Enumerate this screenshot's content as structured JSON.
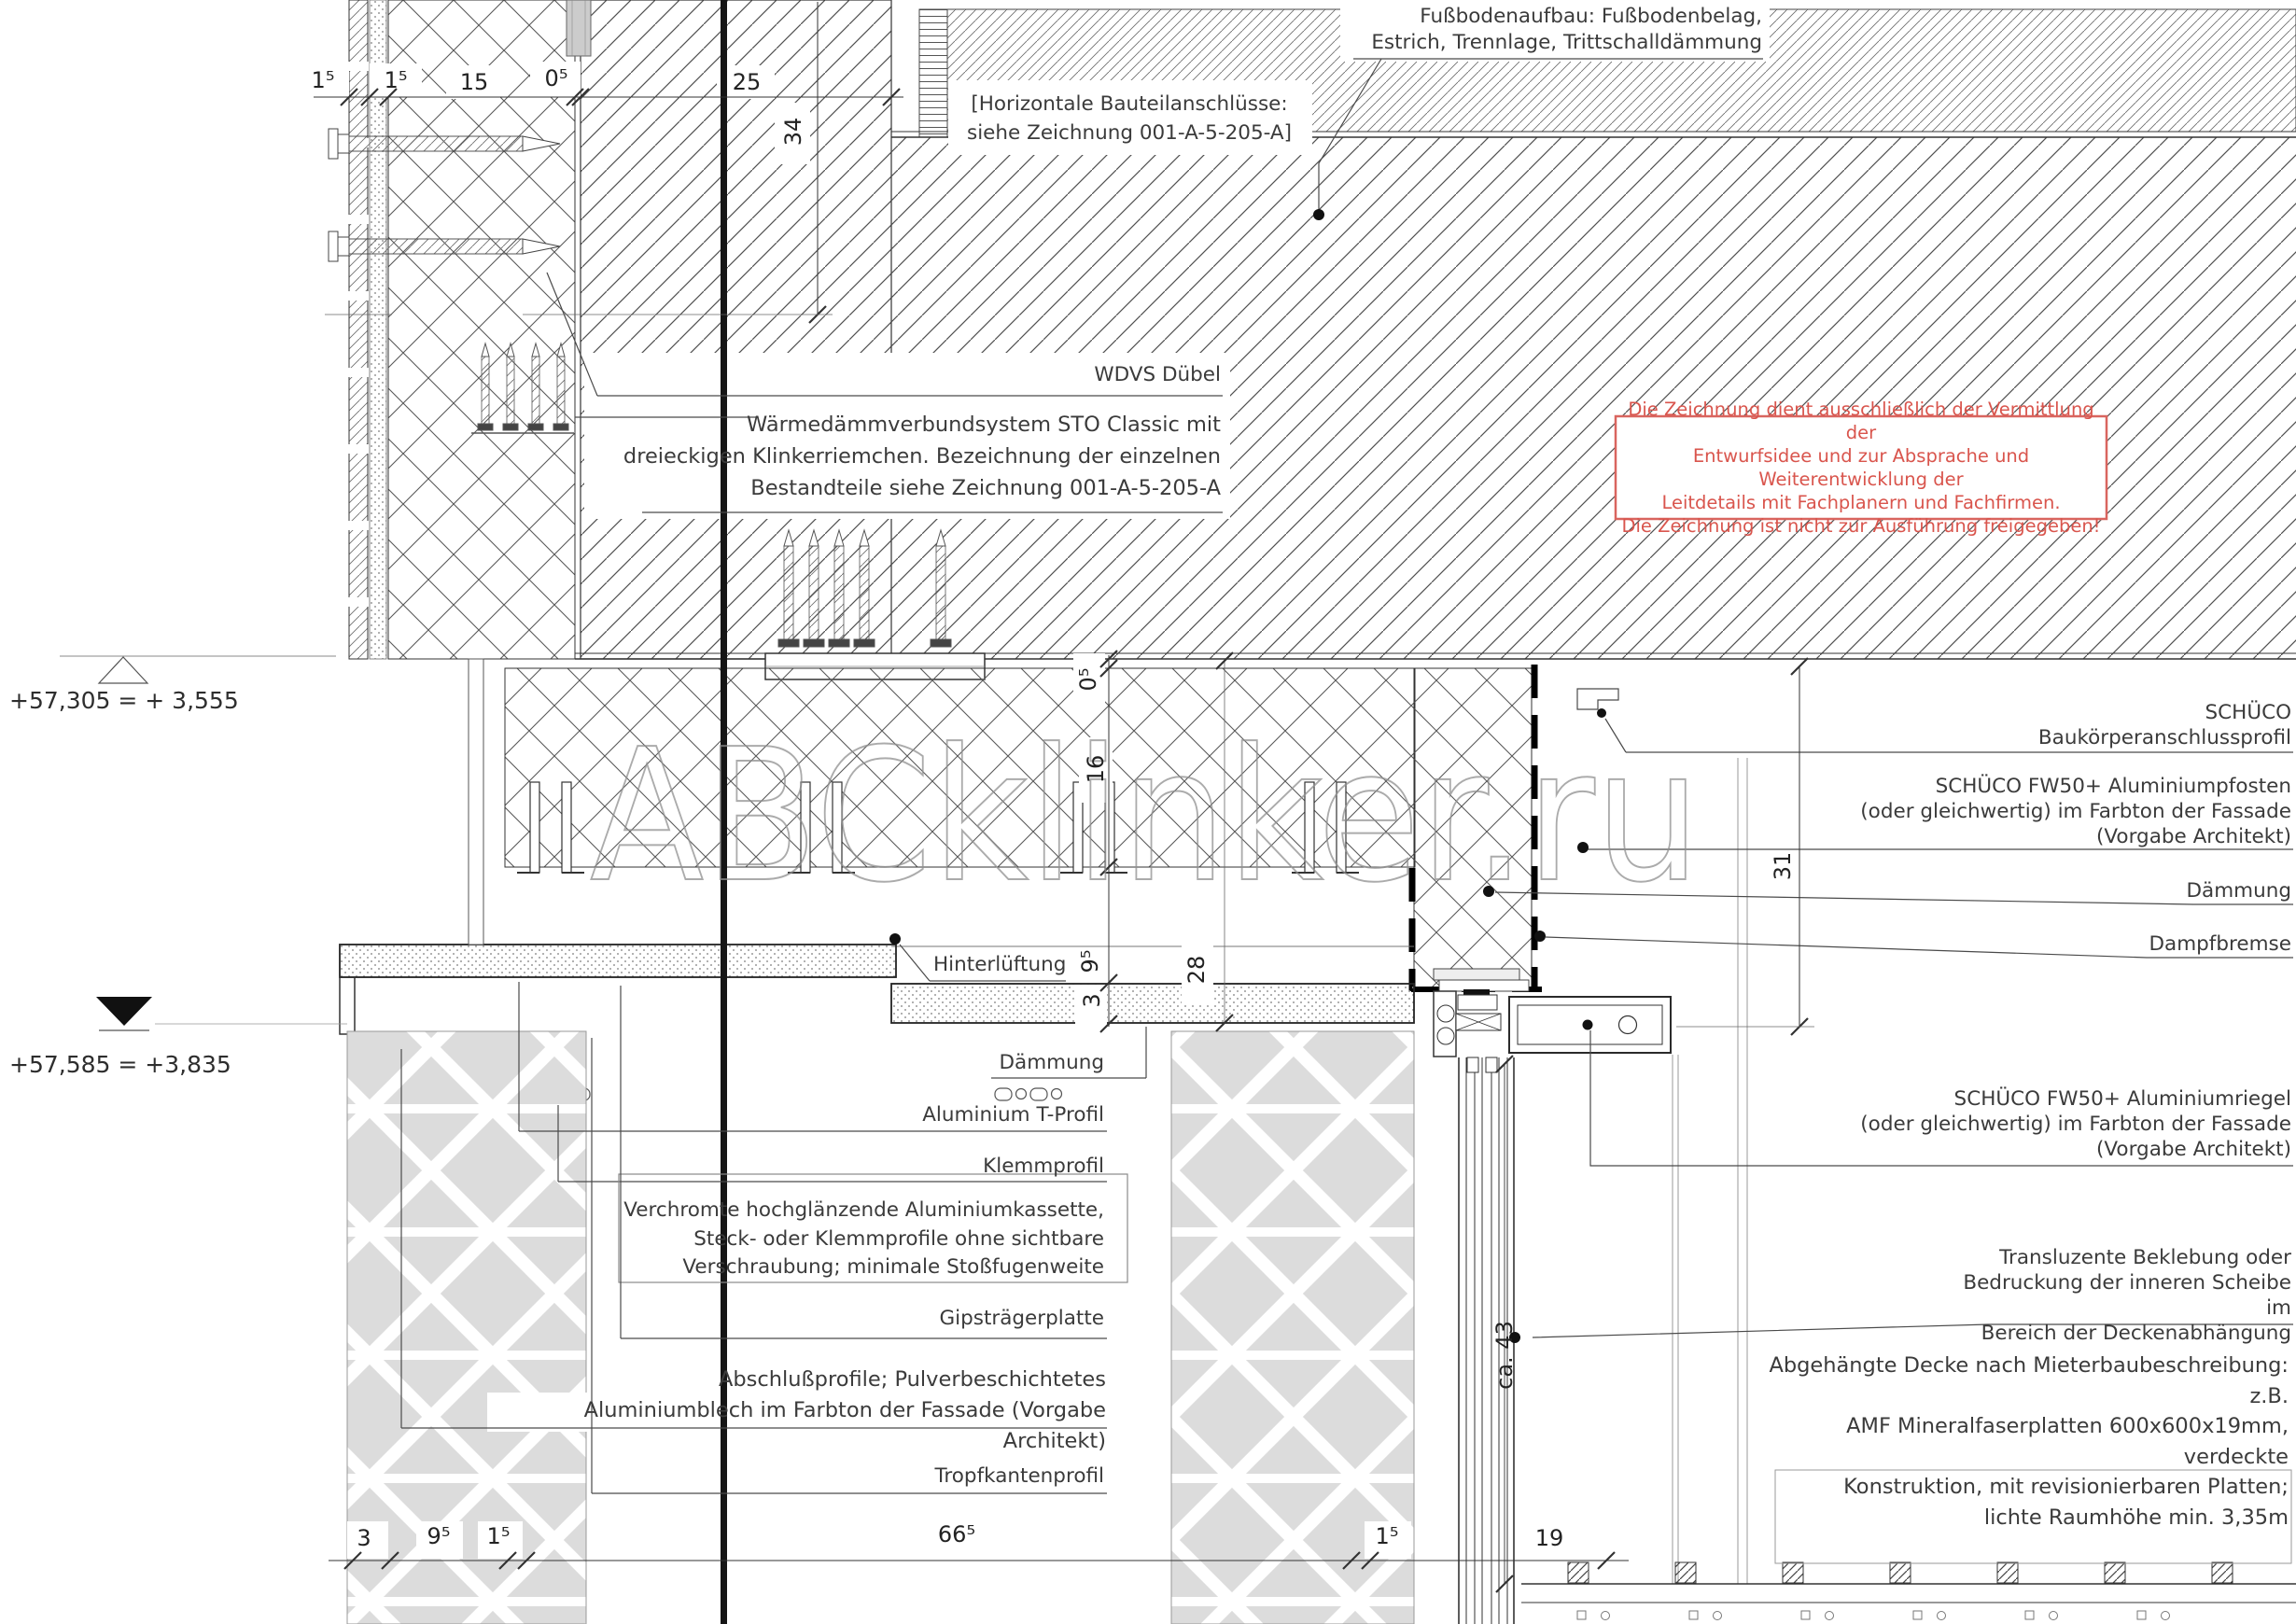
{
  "drawing": {
    "labels": {
      "fussboden": "Fußbodenaufbau: Fußbodenbelag,\nEstrich, Trennlage, Trittschalldämmung",
      "horizontale": "[Horizontale Bauteilanschlüsse:\nsiehe Zeichnung 001-A-5-205-A]",
      "wdvs_duebel": "WDVS Dübel",
      "wdvs_system": "Wärmedämmverbundsystem STO Classic mit\ndreieckigen Klinkerriemchen. Bezeichnung der einzelnen\nBestandteile siehe Zeichnung 001-A-5-205-A",
      "baukoerper": "SCHÜCO\nBaukörperanschlussprofil",
      "pfosten": "SCHÜCO FW50+ Aluminiumpfosten\n(oder gleichwertig) im Farbton der Fassade\n(Vorgabe Architekt)",
      "daemmung_right": "Dämmung",
      "dampfbremse": "Dampfbremse",
      "riegel": "SCHÜCO FW50+ Aluminiumriegel\n(oder gleichwertig) im Farbton der Fassade\n(Vorgabe Architekt)",
      "transluzent": "Transluzente Beklebung oder\nBedruckung der inneren Scheibe im\nBereich der Deckenabhängung",
      "decke": "Abgehängte Decke nach Mieterbaubeschreibung: z.B.\nAMF Mineralfaserplatten 600x600x19mm, verdeckte\nKonstruktion, mit revisionierbaren Platten;\nlichte Raumhöhe min. 3,35m",
      "hinterlueftung": "Hinterlüftung",
      "daemmung_mid": "Dämmung",
      "t_profil": "Aluminium T-Profil",
      "klemmprofil": "Klemmprofil",
      "kassette": "Verchromte hochglänzende Aluminiumkassette,\nSteck- oder Klemmprofile ohne sichtbare\nVerschraubung; minimale Stoßfugenweite",
      "gips": "Gipsträgerplatte",
      "abschluss": "Abschlußprofile; Pulverbeschichtetes\nAluminiumblech im Farbton der Fassade (Vorgabe Architekt)",
      "tropfkante": "Tropfkantenprofil"
    },
    "warning": "Die Zeichnung dient ausschließlich der Vermittlung der\nEntwurfsidee und zur Absprache und Weiterentwicklung der\nLeitdetails mit Fachplanern und Fachfirmen.\nDie Zeichnung ist nicht zur Ausführung freigegeben!",
    "elevations": {
      "upper": "+57,305 = + 3,555",
      "lower": "+57,585 = +3,835"
    },
    "dims": {
      "top": [
        "1⁵",
        "1⁵",
        "15",
        "0⁵",
        "25"
      ],
      "height34": "34",
      "side": {
        "d05": "0⁵",
        "d16": "16",
        "d95": "9⁵",
        "d3": "3",
        "d28": "28",
        "d31": "31",
        "ca43": "ca. 43"
      },
      "bottom": [
        "3",
        "9⁵",
        "1⁵",
        "66⁵",
        "1⁵",
        "19"
      ]
    },
    "watermark": "ABCklinker.ru",
    "colors": {
      "warning_red": "#d9554d",
      "line": "#333333",
      "panel_gray": "#dcdcdc"
    }
  }
}
